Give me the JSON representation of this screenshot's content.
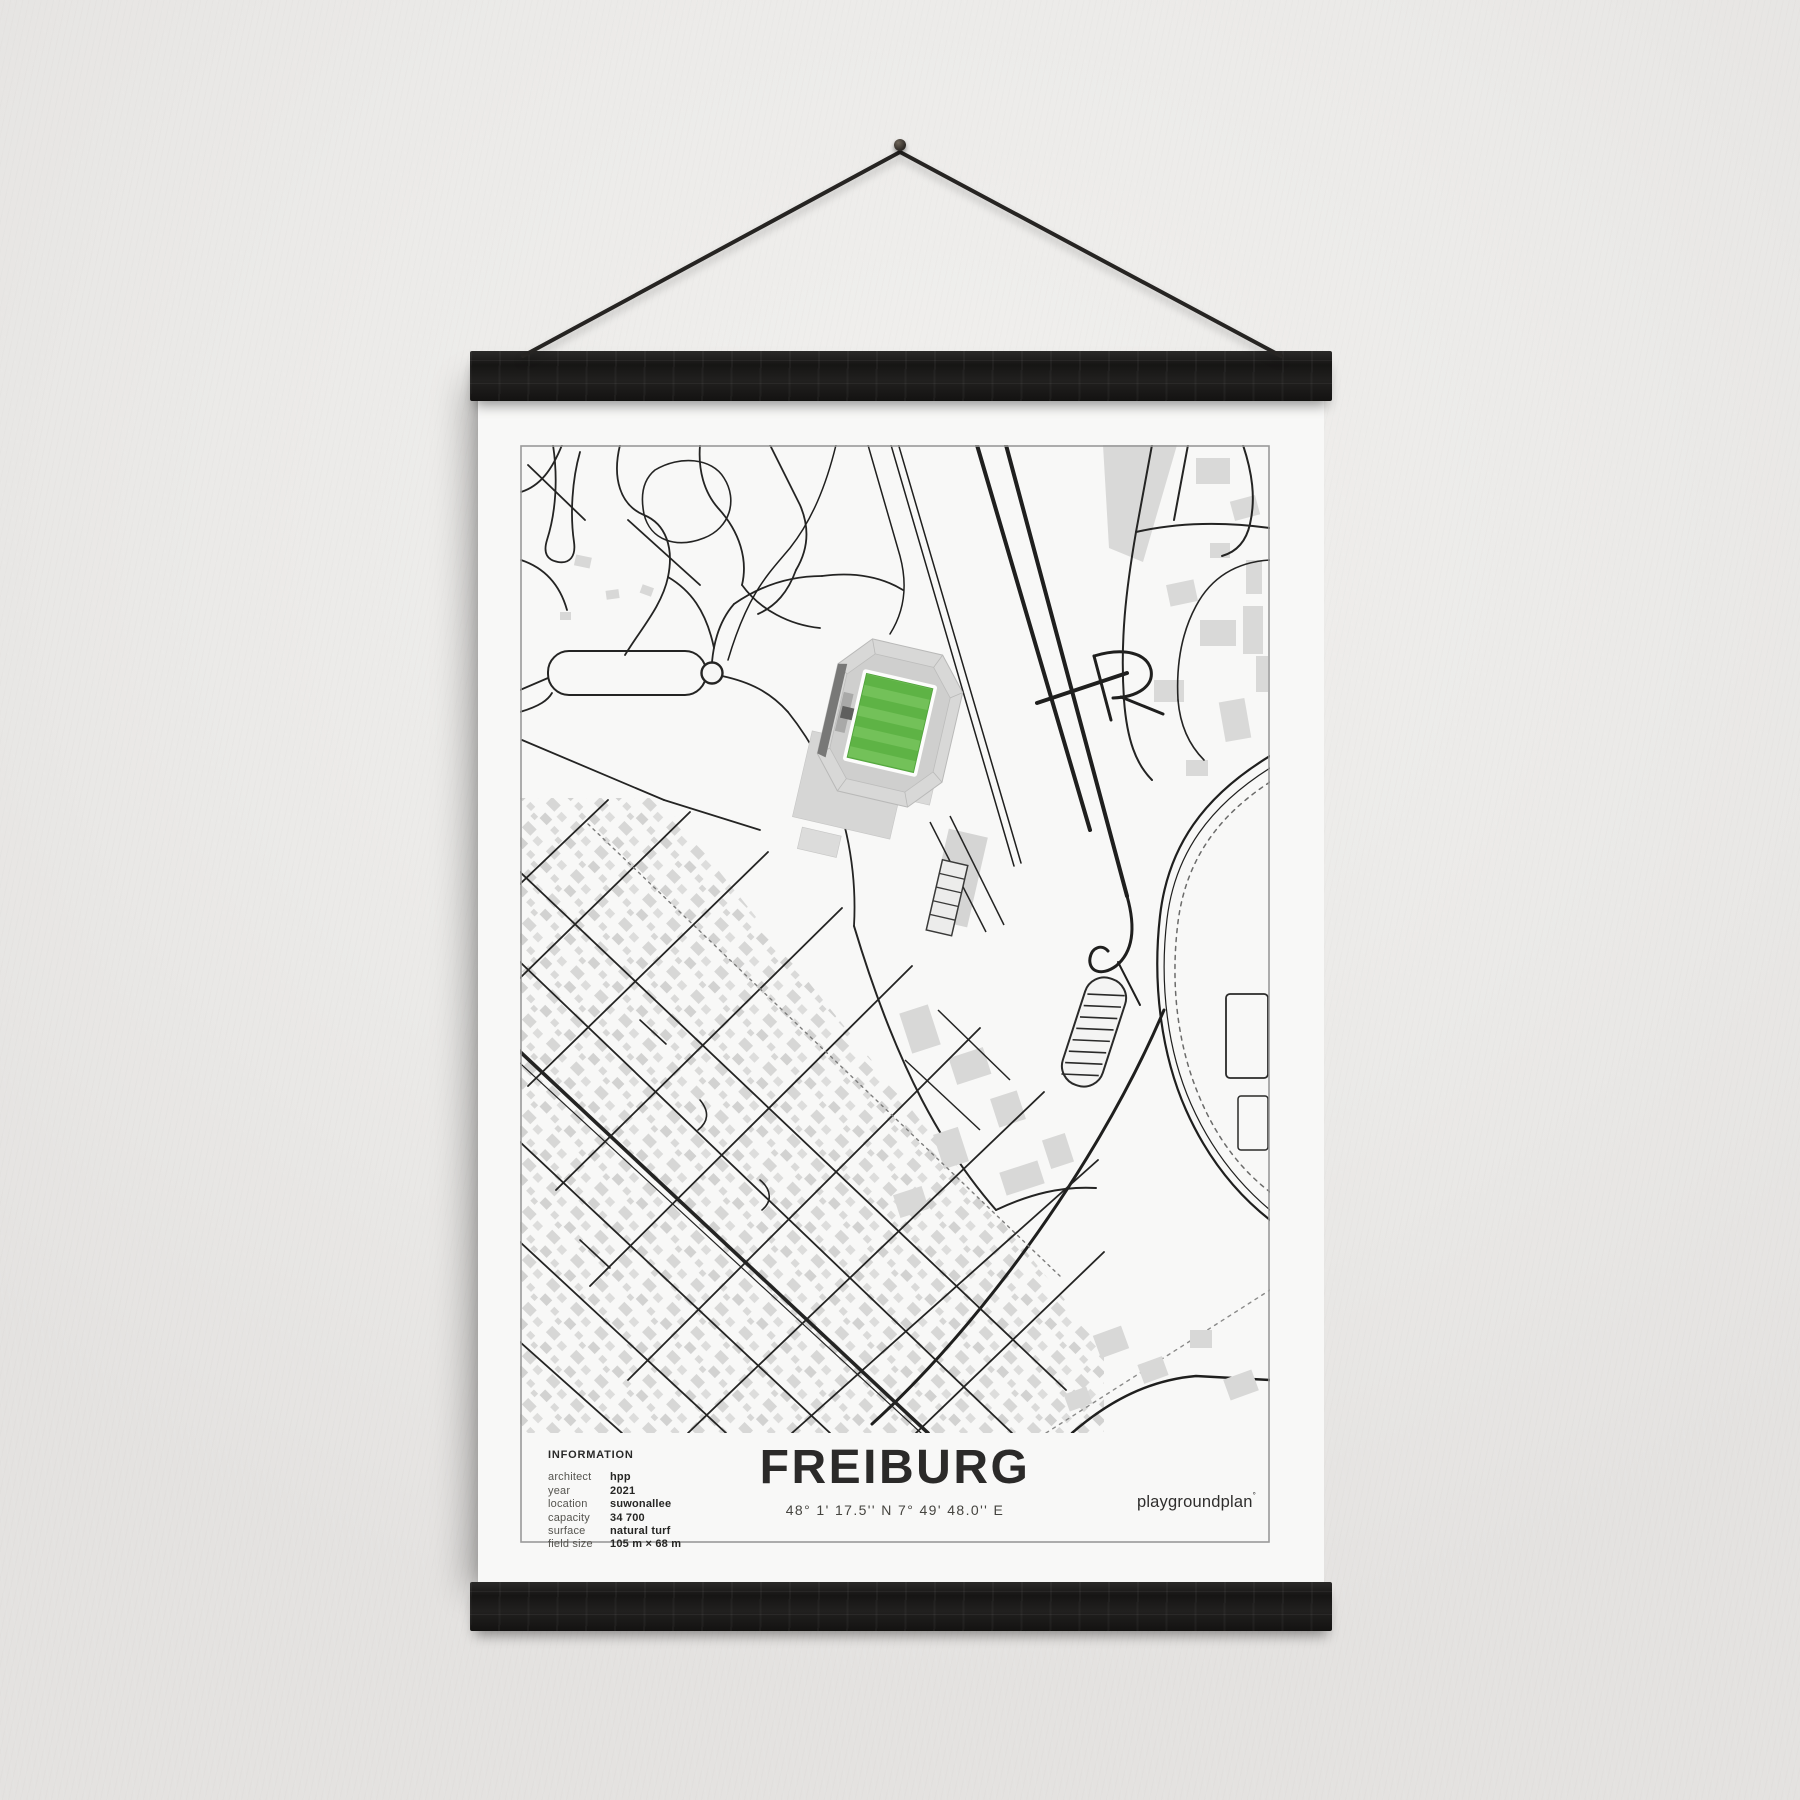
{
  "poster": {
    "title": "FREIBURG",
    "coordinates": "48° 1' 17.5'' N  7° 49' 48.0'' E",
    "brand": "playgroundplan",
    "brand_sup": "°",
    "information": {
      "heading": "INFORMATION",
      "rows": [
        {
          "label": "architect",
          "value": "hpp"
        },
        {
          "label": "year",
          "value": "2021"
        },
        {
          "label": "location",
          "value": "suwonallee"
        },
        {
          "label": "capacity",
          "value": "34 700"
        },
        {
          "label": "surface",
          "value": "natural turf"
        },
        {
          "label": "field size",
          "value": "105 m × 68 m"
        }
      ]
    },
    "colors": {
      "wall": "#ebeae8",
      "paper": "#f8f8f7",
      "hanger_bar": "#171615",
      "map_line": "#1f1f1e",
      "map_frame": "#9a9a99",
      "building_grey": "#d8d8d7",
      "pitch_green": "#5eb345",
      "pitch_stripe": "#73c159"
    }
  }
}
